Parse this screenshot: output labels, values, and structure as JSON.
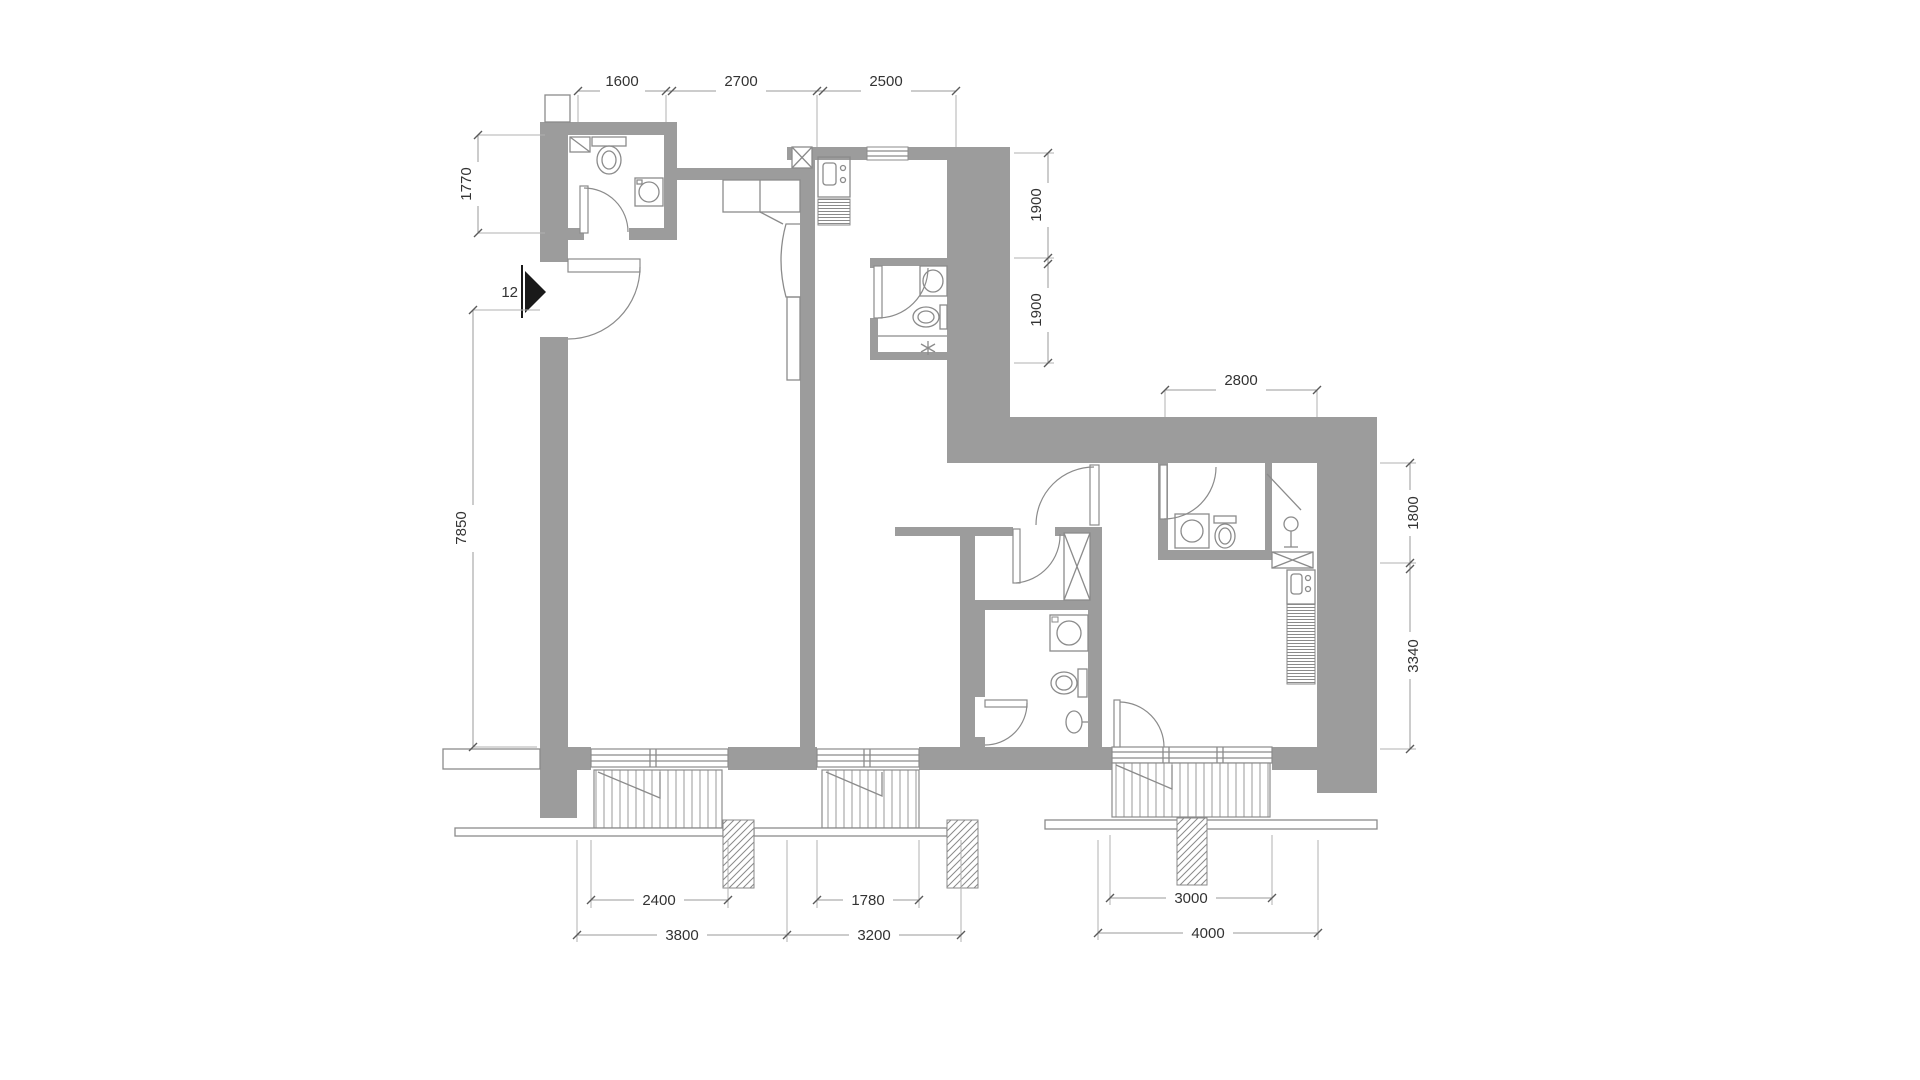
{
  "plan": {
    "unit_number": "12",
    "dimensions": {
      "top": [
        "1600",
        "2700",
        "2500"
      ],
      "left_upper": "1770",
      "left_main": "7850",
      "right_upper": [
        "1900",
        "1900"
      ],
      "middle": "2800",
      "right_lower": [
        "1800",
        "3340"
      ],
      "windows": [
        "2400",
        "1780",
        "3000"
      ],
      "bays": [
        "3800",
        "3200",
        "4000"
      ]
    },
    "colors": {
      "wall": "#9c9c9c",
      "fixture_line": "#8b8b8b",
      "dimension_line": "#9a9a9a",
      "text": "#333333",
      "background": "#ffffff"
    }
  }
}
